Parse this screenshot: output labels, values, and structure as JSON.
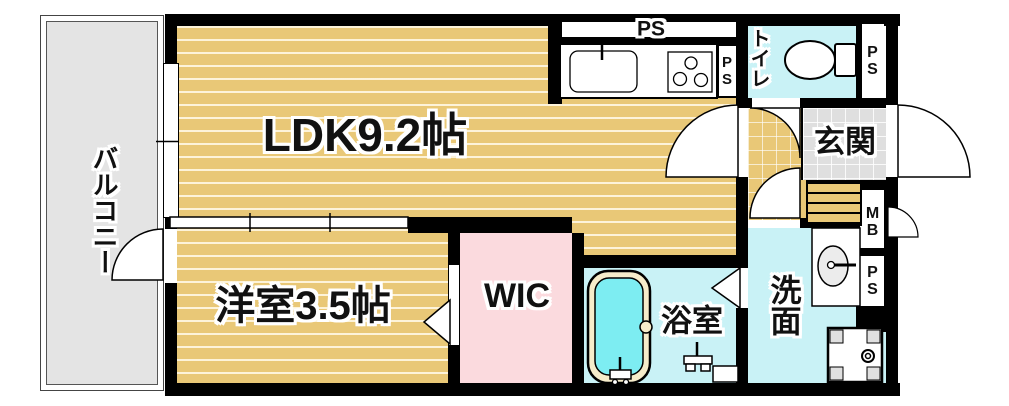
{
  "rooms": {
    "balcony": {
      "label": "バルコニー"
    },
    "ldk": {
      "label": "LDK9.2帖"
    },
    "western_room": {
      "label": "洋室3.5帖"
    },
    "wic": {
      "label": "WIC"
    },
    "bathroom": {
      "label": "浴室"
    },
    "washroom": {
      "label": "洗面"
    },
    "entrance": {
      "label": "玄関"
    },
    "toilet": {
      "label": "トイレ"
    }
  },
  "utility_labels": {
    "ps_kitchen_top": "PS",
    "ps_kitchen_side": "PS",
    "ps_toilet": "PS",
    "mb": "MB",
    "ps_washroom": "PS"
  },
  "colors": {
    "flooring": "#e9c877",
    "floor_stripe": "#f6e9c4",
    "wet_area_cyan": "#c9f2f6",
    "bath_water": "#7dedf2",
    "closet_pink": "#fbdade",
    "balcony_gray": "#e4e4e4",
    "entrance_tile": "#dfdfdf",
    "wall": "#000000"
  }
}
